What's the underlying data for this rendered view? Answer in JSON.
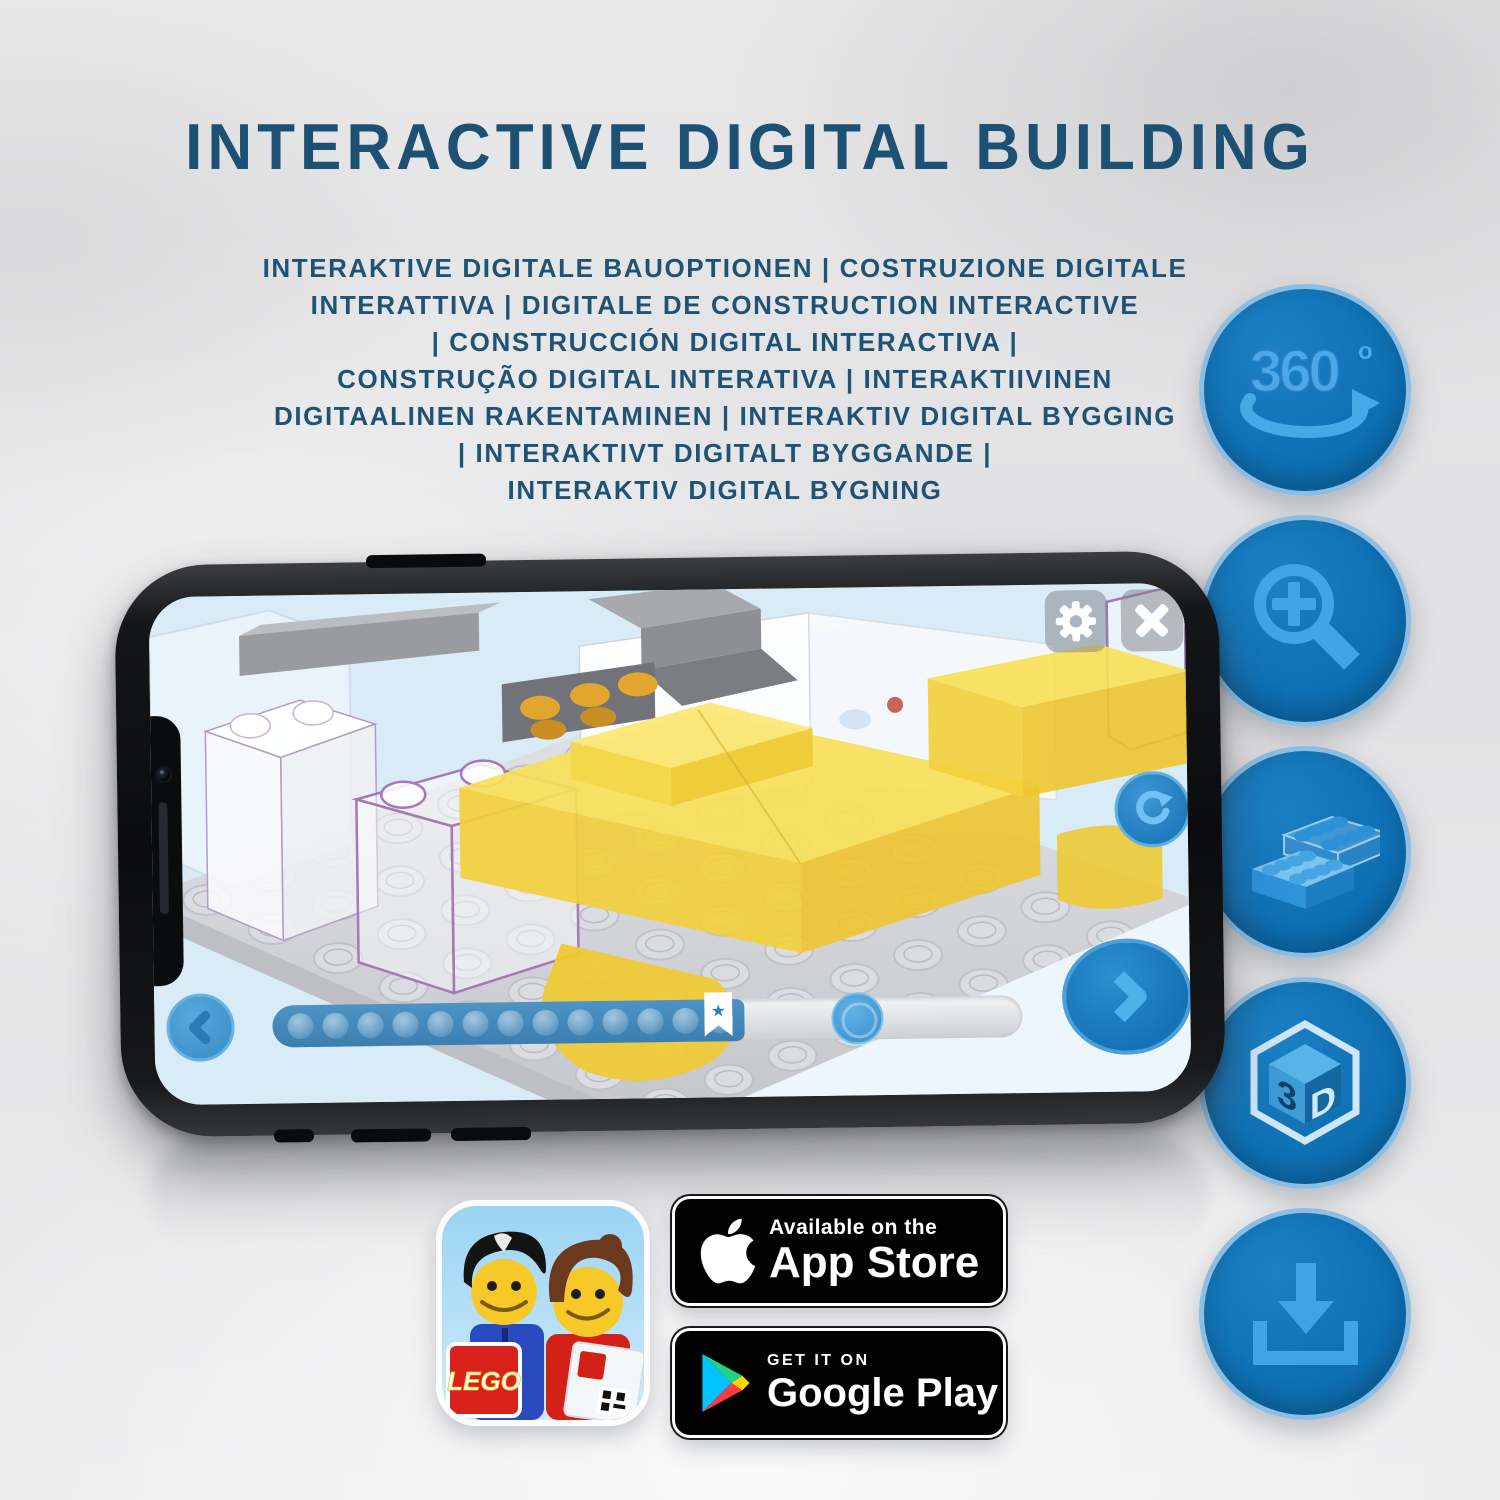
{
  "title": "INTERACTIVE DIGITAL BUILDING",
  "subtitle": {
    "lines": [
      "INTERAKTIVE DIGITALE BAUOPTIONEN | COSTRUZIONE DIGITALE",
      "INTERATTIVA | DIGITALE DE CONSTRUCTION INTERACTIVE",
      "| CONSTRUCCIÓN DIGITAL INTERACTIVA |",
      "CONSTRUÇÃO DIGITAL INTERATIVA | INTERAKTIIVINEN",
      "DIGITAALINEN RAKENTAMINEN | INTERAKTIV DIGITAL BYGGING",
      "| INTERAKTIVT DIGITALT BYGGANDE |",
      "INTERAKTIV DIGITAL BYGNING"
    ]
  },
  "feature_icons": {
    "rotate_360": {
      "label": "360",
      "degree": "o"
    },
    "cube": {
      "left": "3",
      "right": "D"
    }
  },
  "app_icon": {
    "logo": "LEGO"
  },
  "badges": {
    "app_store": {
      "line1": "Available on the",
      "line2": "App Store"
    },
    "google_play": {
      "line1": "GET IT ON",
      "line2": "Google Play"
    }
  },
  "colors": {
    "title_blue": "#1d5174",
    "circle_fill": "#0e6fb2",
    "circle_border": "#8cbde2",
    "icon_glyph": "#42a4e4",
    "progress_blue": "#3b7fb1",
    "brick_yellow": "#f2cf3d",
    "ghost_outline_purple": "#a678b6"
  },
  "progress": {
    "dot_count": 13
  }
}
